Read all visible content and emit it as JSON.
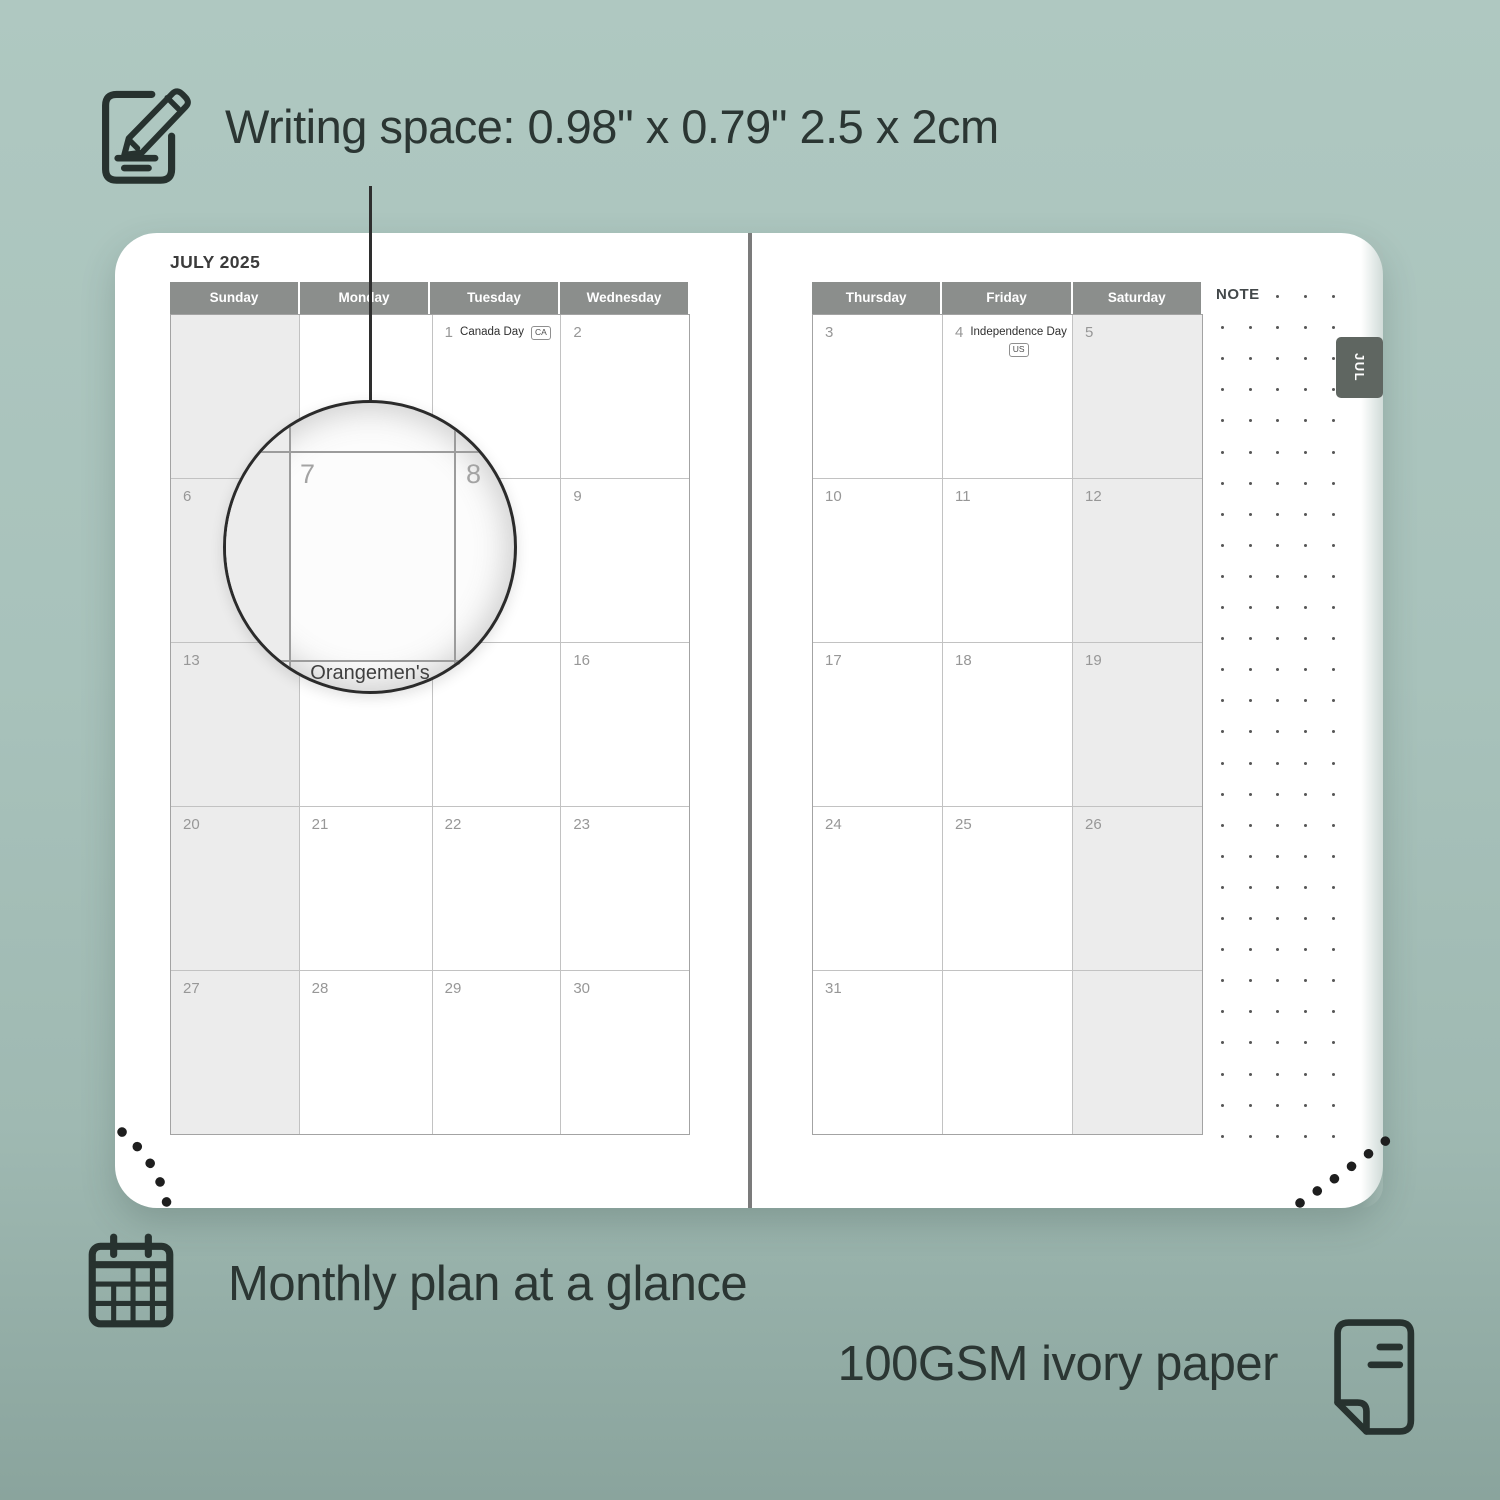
{
  "annotations": {
    "writing_space": "Writing space: 0.98\" x 0.79\" 2.5 x 2cm",
    "monthly_plan": "Monthly plan at a glance",
    "paper": "100GSM ivory paper"
  },
  "planner": {
    "month_title": "JULY 2025",
    "tab_label": "JUL",
    "note_label": "NOTE",
    "left_page": {
      "day_headers": [
        "Sunday",
        "Monday",
        "Tuesday",
        "Wednesday"
      ],
      "shaded_col": 0,
      "rows": [
        [
          {},
          {},
          {
            "n": "1",
            "h": "Canada Day",
            "b": "CA"
          },
          {
            "n": "2"
          }
        ],
        [
          {
            "n": "6"
          },
          {
            "n": "7"
          },
          {
            "n": "8"
          },
          {
            "n": "9"
          }
        ],
        [
          {
            "n": "13"
          },
          {
            "n": "14",
            "h": "Orangemen's Day"
          },
          {
            "n": "15"
          },
          {
            "n": "16"
          }
        ],
        [
          {
            "n": "20"
          },
          {
            "n": "21"
          },
          {
            "n": "22"
          },
          {
            "n": "23"
          }
        ],
        [
          {
            "n": "27"
          },
          {
            "n": "28"
          },
          {
            "n": "29"
          },
          {
            "n": "30"
          }
        ]
      ]
    },
    "right_page": {
      "day_headers": [
        "Thursday",
        "Friday",
        "Saturday"
      ],
      "shaded_col": 2,
      "rows": [
        [
          {
            "n": "3"
          },
          {
            "n": "4",
            "h": "Independence Day",
            "b": "US",
            "badge_below": true
          },
          {
            "n": "5"
          }
        ],
        [
          {
            "n": "10"
          },
          {
            "n": "11"
          },
          {
            "n": "12"
          }
        ],
        [
          {
            "n": "17"
          },
          {
            "n": "18"
          },
          {
            "n": "19"
          }
        ],
        [
          {
            "n": "24"
          },
          {
            "n": "25"
          },
          {
            "n": "26"
          }
        ],
        [
          {
            "n": "31"
          },
          {},
          {}
        ]
      ]
    },
    "magnifier": {
      "left_num": "7",
      "right_num": "8",
      "bottom_text": "Orangemen's"
    }
  },
  "colors": {
    "background_sage": "#a8c2bb",
    "header_gray": "#8b8e8c",
    "tab_gray": "#5f6661",
    "weekend_shade": "#ececec",
    "text_dark": "#2b3633"
  }
}
